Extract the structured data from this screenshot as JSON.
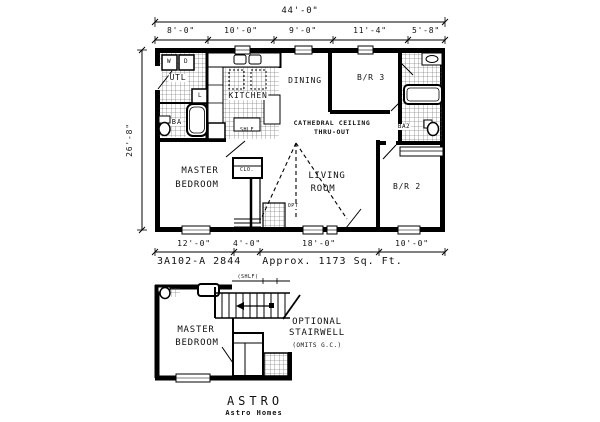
{
  "dims": {
    "overall_width": "44'-0\"",
    "top_segments": [
      "8'-0\"",
      "10'-0\"",
      "9'-0\"",
      "11'-4\"",
      "5'-8\""
    ],
    "left_height": "26'-8\"",
    "bottom_segments": [
      "12'-0\"",
      "4'-0\"",
      "18'-0\"",
      "10'-0\""
    ]
  },
  "caption": "3A102-A 2844   Approx. 1173 Sq. Ft.",
  "main_plan": {
    "utility": "UTL",
    "washer": "W",
    "dryer": "D",
    "linen": "L",
    "bath1": "BA",
    "kitchen": "KITCHEN",
    "shelf": "SHLF",
    "dining": "DINING",
    "bedroom3": "B/R 3",
    "bath2": "BA2",
    "ceiling_line1": "CATHEDRAL CEILING",
    "ceiling_line2": "THRU-OUT",
    "master_line1": "MASTER",
    "master_line2": "BEDROOM",
    "closet": "CLO.",
    "living_line1": "LIVING",
    "living_line2": "ROOM",
    "bedroom2": "B/R 2",
    "opt": "OPT"
  },
  "lower_plan": {
    "shelf": "(SHLF)",
    "master_line1": "MASTER",
    "master_line2": "BEDROOM",
    "note_line1": "OPTIONAL",
    "note_line2": "STAIRWELL",
    "note_line3": "(OMITS G.C.)"
  },
  "footer": {
    "model": "ASTRO",
    "brand": "Astro Homes"
  }
}
